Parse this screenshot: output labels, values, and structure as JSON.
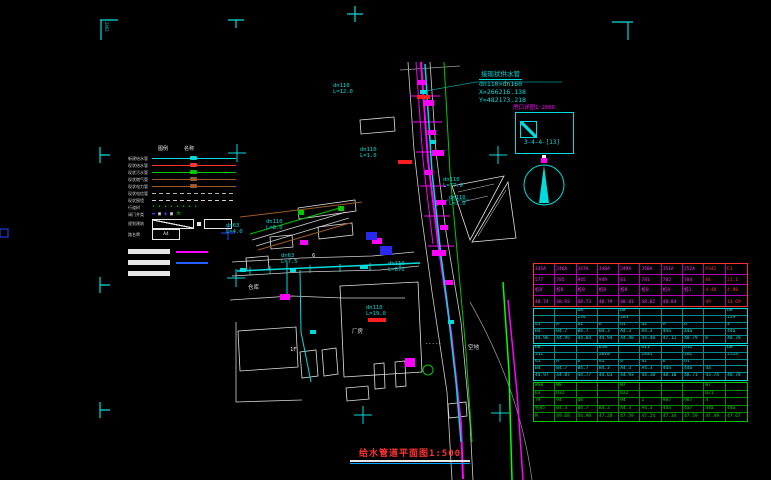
{
  "colors": {
    "cyan": "#00dcdc",
    "magenta": "#ff00ff",
    "red": "#ff3232",
    "green": "#00c800",
    "white": "#e6e6e6",
    "blue": "#2846ff",
    "brown": "#9c5a28"
  },
  "sheet": {
    "corner_code": "2862"
  },
  "connection_note": {
    "lines": [
      "接现状供水管",
      "dn110×dn160",
      "X=266216.138",
      "Y=482173.218"
    ]
  },
  "detail_ref": {
    "label": "甩口详图1:2000",
    "code": "3-4-4-[13]"
  },
  "title": {
    "text": "给水管道平面图1:500"
  },
  "legend": {
    "headers": [
      "图例",
      "名称"
    ],
    "items": [
      {
        "type": "line",
        "color": "#00dcdc",
        "label": "新建给水管"
      },
      {
        "type": "line",
        "color": "#ff3232",
        "label": "现状给水管"
      },
      {
        "type": "line",
        "color": "#00c800",
        "label": "现状污水管"
      },
      {
        "type": "line",
        "color": "#9c5a28",
        "label": "现状燃气管"
      },
      {
        "type": "line",
        "color": "#9c5a28",
        "label": "现状电力管"
      },
      {
        "type": "line",
        "color": "#b4b4b4",
        "dashed": true,
        "label": "现状电信管"
      },
      {
        "type": "line",
        "color": "#d2d2d2",
        "dashed": true,
        "label": "现状围墙"
      },
      {
        "type": "dots",
        "color": "#00c800",
        "label": "行道树"
      },
      {
        "type": "symbols",
        "label": "阀门井类"
      },
      {
        "type": "rectdiag",
        "label": "规划建筑"
      },
      {
        "type": "labelbox",
        "text": "A4",
        "label": "路名牌"
      }
    ],
    "bars": [
      {
        "line": "#ff00ff"
      },
      {
        "line": "#2860ff"
      },
      {}
    ]
  },
  "pipe_labels": [
    {
      "size": "dn110",
      "len": "L=12.0",
      "x": 333,
      "y": 84
    },
    {
      "size": "dn110",
      "len": "L=1.0",
      "x": 360,
      "y": 148
    },
    {
      "size": "dn110",
      "len": "L=77.0",
      "x": 443,
      "y": 178
    },
    {
      "size": "dn110",
      "len": "L=7.0",
      "x": 449,
      "y": 196
    },
    {
      "size": "dn63",
      "len": "L=4.0",
      "x": 226,
      "y": 224
    },
    {
      "size": "dn110",
      "len": "L=8.0",
      "x": 266,
      "y": 220
    },
    {
      "size": "dn63",
      "len": "L=7.5",
      "x": 281,
      "y": 254
    },
    {
      "size": "dn110",
      "len": "L=8.0",
      "x": 388,
      "y": 262
    },
    {
      "size": "dn110",
      "len": "L=19.0",
      "x": 366,
      "y": 306
    }
  ],
  "map_labels": [
    {
      "t": "仓库",
      "x": 248,
      "y": 286
    },
    {
      "t": "6",
      "x": 312,
      "y": 254
    },
    {
      "t": "1F",
      "x": 290,
      "y": 348
    },
    {
      "t": "厂房",
      "x": 352,
      "y": 330
    },
    {
      "t": "空地",
      "x": 468,
      "y": 346
    },
    {
      "t": "-----",
      "x": 425,
      "y": 342
    }
  ],
  "table": {
    "sections": [
      {
        "border": "#ff3232",
        "grid": "#b400b4",
        "text": "#ff30ff",
        "red_last_cols": true,
        "h": 44,
        "rows": [
          [
            "J45A",
            "J46A",
            "J47A",
            "J48A",
            "J49A",
            "J50A",
            "J51A",
            "J52A",
            "P342",
            "E1"
          ],
          [
            "577",
            "785",
            "945",
            "949",
            "81",
            "781",
            "782",
            "784",
            "84",
            "21.1"
          ],
          [
            "桩8",
            "桩8",
            "桩8",
            "桩8",
            "桩8",
            "桩8",
            "桩8",
            "桩1",
            "4-4B",
            "4.98"
          ],
          [
            "48.74",
            "48.93",
            "48.73",
            "48.79",
            "48.81",
            "48.82",
            "48.84",
            "",
            "49",
            "14.69"
          ]
        ]
      },
      {
        "border": "#00dcdc",
        "grid": "#008c8c",
        "text": "#00e6e6",
        "h": 36,
        "rows": [
          [
            "",
            "",
            "D8",
            "",
            "D8",
            "",
            "",
            "",
            "",
            "D8"
          ],
          [
            "",
            "",
            "234",
            "",
            "283",
            "",
            "",
            "",
            "",
            "229"
          ],
          [
            "d1",
            "A",
            "d1",
            "b",
            "d1",
            "d2",
            "M",
            "b",
            "",
            "x"
          ],
          [
            "B4",
            "B4.7",
            "B4.7",
            "B4.3",
            "A4.3",
            "A4.3",
            "44a",
            "44a",
            "",
            "44a"
          ],
          [
            "44.96",
            "44.95",
            "44.84",
            "44.94",
            "44.98",
            "44.48",
            "47.11",
            "48.79",
            "m",
            "48.78"
          ]
        ]
      },
      {
        "border": "#00dcdc",
        "grid": "#008c8c",
        "text": "#00e6e6",
        "h": 36,
        "rows": [
          [
            "D8",
            "",
            "",
            "D10",
            "",
            "D11",
            "",
            "D12",
            "",
            "D8"
          ],
          [
            "232",
            "",
            "",
            "2810",
            "",
            "2831",
            "",
            "282",
            "",
            "2513"
          ],
          [
            "d1",
            "A",
            "b",
            "d1",
            "b",
            "d1",
            "b",
            "d1",
            "",
            ""
          ],
          [
            "B4",
            "B4.7",
            "B4.7",
            "B4.3",
            "A4.3",
            "A4.3",
            "44a",
            "44a",
            "4a",
            ""
          ],
          [
            "44.97",
            "44.87",
            "44.77",
            "44.63",
            "44.93",
            "44.10",
            "48.10",
            "48.71",
            "43.74",
            "48.78"
          ]
        ]
      },
      {
        "border": "#00c800",
        "grid": "#008c00",
        "text": "#00dc00",
        "h": 40,
        "rows": [
          [
            "WS8",
            "W8",
            "",
            "",
            "W7",
            "",
            "",
            "",
            "W7",
            ""
          ],
          [
            "D3",
            "D32",
            "",
            "",
            "D22",
            "",
            "",
            "",
            "D21",
            ""
          ],
          [
            "79",
            "94",
            "48",
            "",
            "94",
            "1",
            "987",
            "987",
            "4",
            ""
          ],
          [
            "桩85",
            "B4.3",
            "B4.7",
            "B4.3",
            "A4.3",
            "A4.3",
            "44a",
            "4a7",
            "44a",
            "44a"
          ],
          [
            "M",
            "49.68",
            "44.98",
            "47.28",
            "47.59",
            "47.24",
            "47.34",
            "47.59",
            "47.49",
            "47.67"
          ]
        ]
      }
    ]
  }
}
